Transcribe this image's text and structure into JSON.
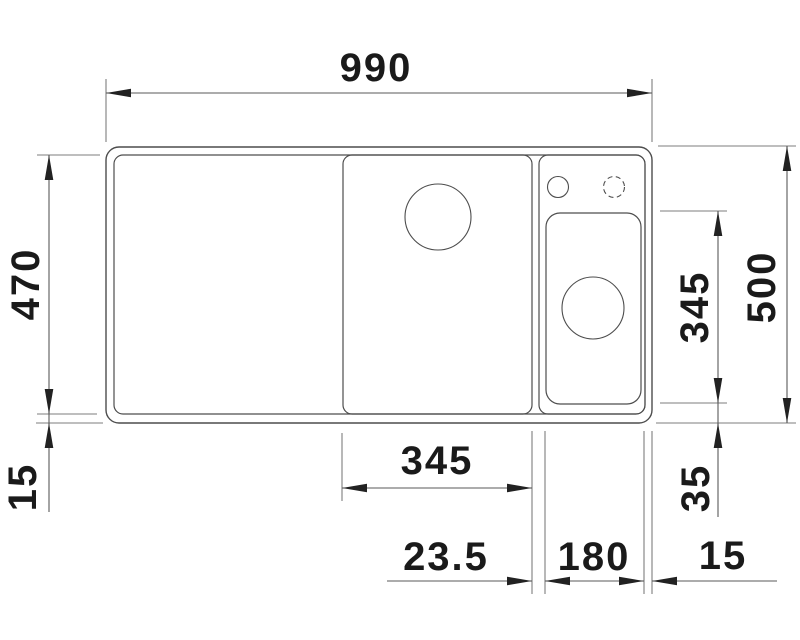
{
  "drawing": {
    "title": "Sink technical drawing, top view with dimensions",
    "colors": {
      "background": "#ffffff",
      "outline": "#4d4d4d",
      "extension": "#7d7d7d",
      "dimension": "#5a5a5a",
      "arrow": "#222222",
      "text": "#1a1a1a"
    },
    "dims": {
      "overall_width": "990",
      "inner_depth": "470",
      "rim_bottom": "15",
      "main_bowl_width": "345",
      "partition_width": "23.5",
      "small_bowl_width": "180",
      "rim_right": "15",
      "small_bowl_depth": "345",
      "small_bowl_bottom_offset": "35",
      "overall_depth": "500"
    }
  }
}
